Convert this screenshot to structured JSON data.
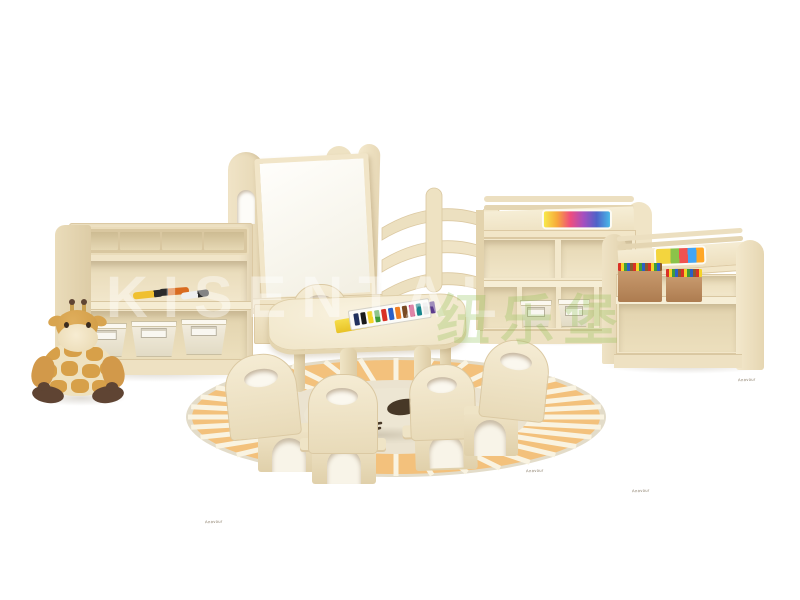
{
  "scene": {
    "description": "Product photo: children's kindergarten furniture set in light birch wood on white background",
    "background_color": "#ffffff"
  },
  "watermark": {
    "latin": "KISENTAL",
    "cjk": "纽乐堡"
  },
  "brand_stamp": "Anovour",
  "palette": {
    "wood_light": "#f3e8ce",
    "wood_mid": "#e9dbb8",
    "wood_shadow": "#d9c7a1",
    "whiteboard": "#fefdf9",
    "rug_orange": "#f3c17c",
    "rug_inner": "#ebe3d0",
    "rug_stripe": "#f9f3e1",
    "giraffe_tan": "#d7a049",
    "giraffe_brown": "#5f4433",
    "bin_cream": "#efe9da",
    "crayon_box_tan": "#c08f66",
    "rainbow_paper": [
      "#f7e94a",
      "#f7a93b",
      "#ef4d7e",
      "#a44fc0",
      "#4f63c8",
      "#49b8e8"
    ],
    "paint_tubes": [
      "#20315e",
      "#1a1a1a",
      "#f4d327",
      "#3f9c3a",
      "#d93025",
      "#2b5fc7",
      "#f07f23",
      "#7a4a22",
      "#c42b68",
      "#17858c",
      "#e8e8e8",
      "#5b3b8c"
    ]
  },
  "rug": {
    "stripe_count": 36
  },
  "items": [
    "plush giraffe toy",
    "art supply caddy unit with marker pens and three cream storage bins",
    "whiteboard easel with arched side panel and storage base",
    "curved corner bookshelf",
    "storage cabinet with rainbow display paper and two cream bins",
    "display shelf unit with two crayon boxes",
    "kids activity table with watercolor paint set",
    "five toddler chairs with grip cutouts",
    "round sunburst rug with lion face motif"
  ]
}
